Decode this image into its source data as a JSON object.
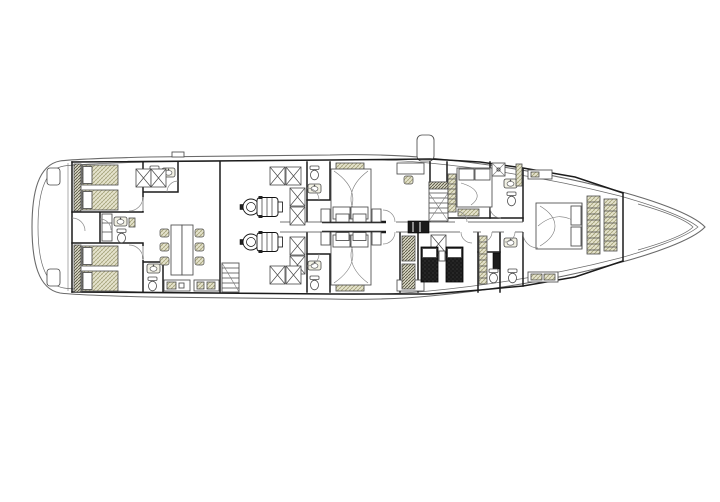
{
  "meta": {
    "type": "yacht-deck-plan",
    "description": "Lower deck general arrangement plan of a motor yacht, bow to the right, shown in black line-work on white with khaki hatched upholstery",
    "orientation": "bow-right",
    "visible_text": "none"
  },
  "colors": {
    "paper": "#ffffff",
    "hull_line": "#6a6a6a",
    "wall": "#1c1c1c",
    "furniture_line": "#4a4a4a",
    "upholstery_bg": "#e5e3cd",
    "upholstery_hatch": "#8f8c5c",
    "dark_bed": "#1b1b1b",
    "arc": "#8a8a8a"
  },
  "rooms": [
    {
      "id": "aft-deck",
      "name": "Aft deck",
      "features": [
        "rounded stern",
        "2 deck lockers",
        "entry door"
      ]
    },
    {
      "id": "aft-port-twin-cabin",
      "name": "Aft port twin cabin",
      "single_beds": 2
    },
    {
      "id": "aft-starboard-twin-cabin",
      "name": "Aft starboard twin cabin",
      "single_beds": 2
    },
    {
      "id": "aft-port-bathroom",
      "name": "Aft port bathroom",
      "fixtures": [
        "wc",
        "basin"
      ]
    },
    {
      "id": "aft-starboard-bathroom",
      "name": "Aft starboard bathroom",
      "fixtures": [
        "wc",
        "basin"
      ]
    },
    {
      "id": "central-bathroom",
      "name": "Central aft bathroom",
      "fixtures": [
        "cabinet",
        "basin",
        "wc"
      ]
    },
    {
      "id": "salon-dining",
      "name": "Salon / dining room",
      "furniture": [
        "dining table",
        "6 chairs",
        "2 skylight hatches"
      ]
    },
    {
      "id": "galley",
      "name": "Galley counters",
      "units": 2
    },
    {
      "id": "salon-staircase",
      "name": "Salon staircase"
    },
    {
      "id": "engine-room",
      "name": "Engine room",
      "engines": 2,
      "tanks": 8
    },
    {
      "id": "port-guest-cabin",
      "name": "Port guest cabin",
      "double_beds": 1,
      "furniture": [
        "sofa",
        "desk",
        "2 nightstands"
      ]
    },
    {
      "id": "starboard-guest-cabin",
      "name": "Starboard guest cabin",
      "double_beds": 1,
      "furniture": [
        "sofa",
        "desk",
        "2 nightstands"
      ]
    },
    {
      "id": "port-guest-bathroom",
      "name": "Port guest bathroom",
      "fixtures": [
        "wc",
        "basin"
      ]
    },
    {
      "id": "starboard-guest-bathroom",
      "name": "Starboard guest bathroom",
      "fixtures": [
        "wc",
        "basin"
      ]
    },
    {
      "id": "corridor",
      "name": "Central corridor"
    },
    {
      "id": "midship-staircase",
      "name": "Midship staircase"
    },
    {
      "id": "vip-cabin",
      "name": "VIP cabin",
      "double_beds": 1,
      "furniture": [
        "wardrobe",
        "bench"
      ]
    },
    {
      "id": "vip-bathroom",
      "name": "VIP bathroom",
      "fixtures": [
        "shower",
        "basin",
        "wc",
        "cabinet"
      ]
    },
    {
      "id": "crew-cabin",
      "name": "Crew cabin",
      "berths": 2
    },
    {
      "id": "forward-bathrooms",
      "name": "Forward bathrooms",
      "fixtures": [
        "2 wc",
        "basin",
        "shelving"
      ]
    },
    {
      "id": "master-cabin",
      "name": "Master cabin",
      "double_beds": 1,
      "furniture": [
        "2 wardrobe towers",
        "dresser",
        "bench"
      ]
    },
    {
      "id": "bow-locker",
      "name": "Bow locker"
    }
  ],
  "deck_fittings": [
    {
      "id": "deck-hatch",
      "name": "Deck hatch / funnel above plan"
    },
    {
      "id": "stern-locker-top",
      "name": "Stern locker (port)"
    },
    {
      "id": "stern-locker-bottom",
      "name": "Stern locker (starboard)"
    }
  ]
}
